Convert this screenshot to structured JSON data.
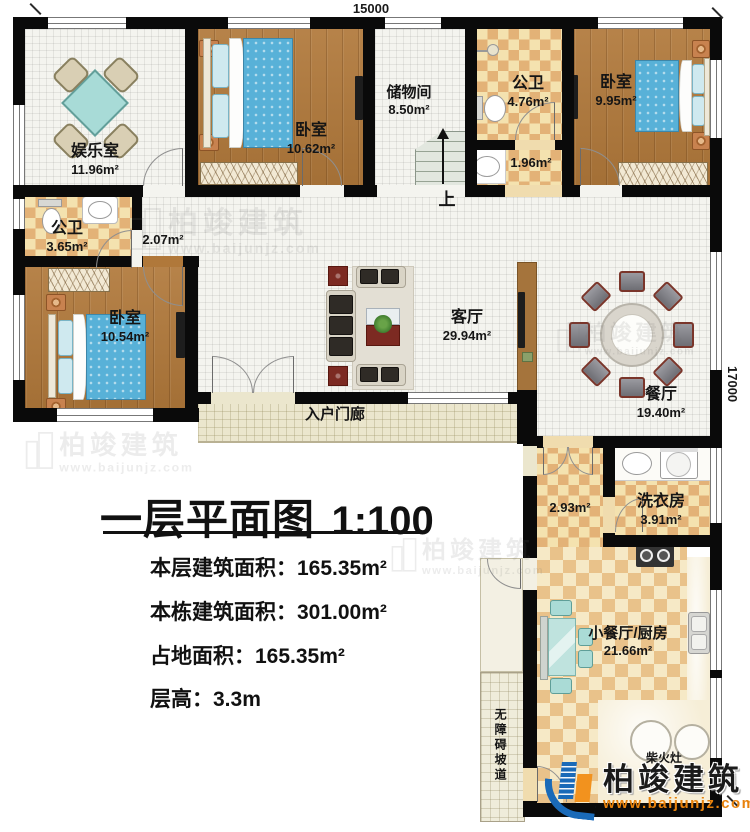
{
  "dimensions": {
    "top": "15000",
    "right": "17000"
  },
  "rooms": {
    "entertainment": {
      "name": "娱乐室",
      "area": "11.96m²"
    },
    "bedroom1": {
      "name": "卧室",
      "area": "10.62m²"
    },
    "storage": {
      "name": "储物间",
      "area": "8.50m²"
    },
    "bath_top": {
      "name": "公卫",
      "area": "4.76m²"
    },
    "bedroom2": {
      "name": "卧室",
      "area": "9.95m²"
    },
    "bath_left": {
      "name": "公卫",
      "area": "3.65m²"
    },
    "hall": {
      "area": "2.07m²"
    },
    "bath_sub": {
      "area": "1.96m²"
    },
    "bedroom3": {
      "name": "卧室",
      "area": "10.54m²"
    },
    "living": {
      "name": "客厅",
      "area": "29.94m²"
    },
    "dining": {
      "name": "餐厅",
      "area": "19.40m²"
    },
    "porch": {
      "name": "入户门廊"
    },
    "corridor": {
      "area": "2.93m²"
    },
    "laundry": {
      "name": "洗衣房",
      "area": "3.91m²"
    },
    "kitchen": {
      "name": "小餐厅/厨房",
      "area": "21.66m²"
    },
    "stove": {
      "name": "柴火灶"
    },
    "ramp": {
      "name": "无障碍坡道"
    }
  },
  "stairs": {
    "up": "上"
  },
  "title": {
    "text": "一层平面图",
    "scale": "1:100"
  },
  "stats": {
    "floor_area": "本层建筑面积：165.35m²",
    "total_area": "本栋建筑面积：301.00m²",
    "footprint": "占地面积：165.35m²",
    "height": "层高：3.3m"
  },
  "watermark": {
    "brand": "柏竣建筑",
    "url": "www.baijunjz.com"
  },
  "colors": {
    "wall": "#0a0a0a",
    "wood_floor": "#b0783a",
    "checker_dark": "#e3b277",
    "checker_light": "#f4e2af",
    "bed_blue": "#58b1d8",
    "table_teal": "#a8dbd7",
    "logo_blue": "#1a6ab8",
    "logo_orange": "#f2921e",
    "url_orange": "#e8820c"
  }
}
